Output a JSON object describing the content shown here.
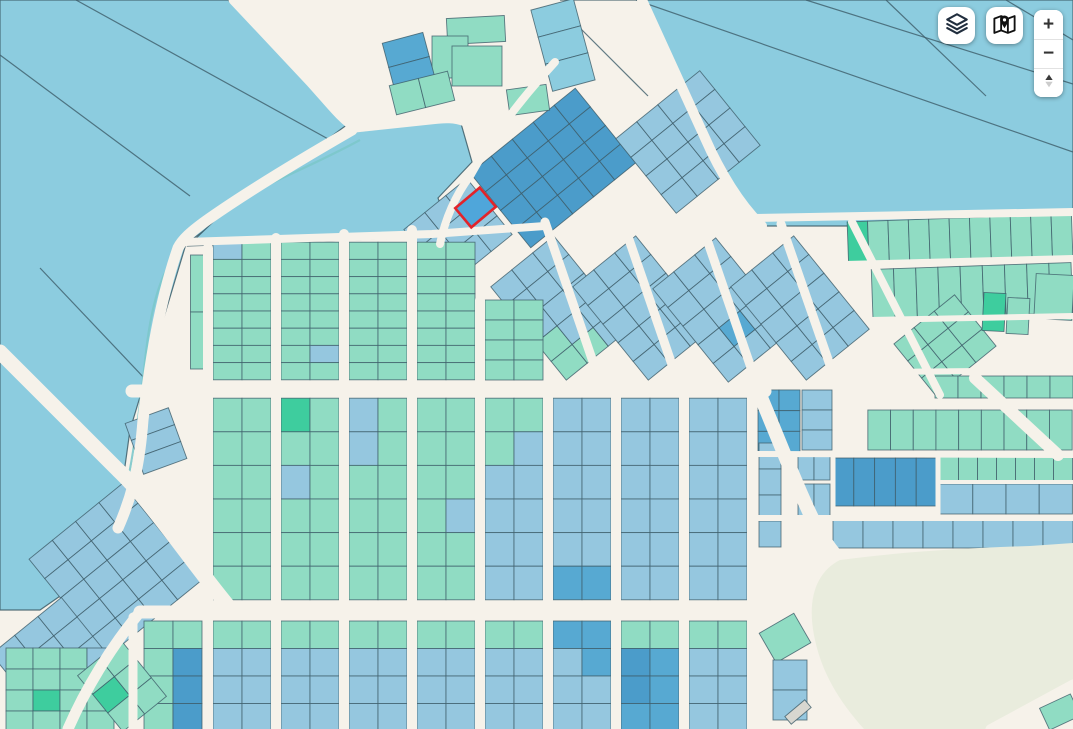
{
  "controls": {
    "layers_button": {
      "icon": "layers-icon"
    },
    "basemap_button": {
      "icon": "map-marker-icon"
    },
    "zoom_in_label": "+",
    "zoom_out_label": "−",
    "compass": {
      "icon": "compass-icon"
    }
  },
  "map": {
    "colors": {
      "st": "#f6f2ea",
      "fb": "#8cccdf",
      "lb": "#95c7df",
      "mb": "#57a9d2",
      "db": "#4b9cca",
      "t": "#90dcc3",
      "e": "#3ecd9e",
      "out": "#3d5d69",
      "beige": "#e9ecdd",
      "red": "#e2232a",
      "canal": "#7cc8cb",
      "hl": "#4fa6da",
      "gray": "#d8d7d0"
    },
    "field_polygons": [
      [
        "0,0 228,0 348,124 186,244 130,430 112,560 40,610 0,610",
        "fb"
      ],
      [
        "238,198 352,132 460,120 472,162 438,198 452,236 188,246",
        "fb"
      ],
      [
        "560,0 1073,0 1073,213 858,226 762,226 700,140 642,0",
        "fb"
      ]
    ],
    "boundary_lines": [
      [
        0,
        55,
        190,
        196
      ],
      [
        76,
        0,
        330,
        140
      ],
      [
        40,
        268,
        148,
        382
      ],
      [
        636,
        0,
        1073,
        152
      ],
      [
        806,
        0,
        1073,
        84
      ],
      [
        886,
        0,
        986,
        96
      ],
      [
        1006,
        0,
        1073,
        40
      ],
      [
        564,
        12,
        648,
        96
      ]
    ],
    "canal": "M360,140 C290,178 225,198 196,230 C162,262 152,300 146,352 C140,410 132,470 116,536",
    "grids": [
      [
        553,
        168,
        5,
        4,
        27,
        24,
        -39,
        "db",
        null
      ],
      [
        688,
        142,
        4,
        4,
        27,
        24,
        -39,
        "lb",
        null
      ],
      [
        458,
        232,
        3,
        3,
        27,
        24,
        -39,
        "lb",
        {
          "2,0": "t"
        }
      ],
      [
        560,
        308,
        3,
        5,
        27,
        24,
        -39,
        "lb",
        {
          "4,0": "t",
          "4,1": "t",
          "3,0": "t"
        }
      ],
      [
        642,
        308,
        3,
        5,
        27,
        24,
        -39,
        "lb",
        null
      ],
      [
        722,
        310,
        3,
        5,
        27,
        24,
        -39,
        "lb",
        {
          "3,1": "mb"
        }
      ],
      [
        800,
        308,
        3,
        5,
        27,
        24,
        -39,
        "lb",
        null
      ],
      [
        115,
        570,
        4,
        5,
        30,
        25,
        -39,
        "lb",
        null
      ],
      [
        50,
        655,
        3,
        3,
        30,
        25,
        -39,
        "lb",
        null
      ],
      [
        156,
        441,
        1,
        3,
        46,
        18,
        -20,
        "lb",
        null
      ],
      [
        200,
        312,
        1,
        2,
        19,
        57,
        0,
        "t",
        null
      ],
      [
        242,
        311,
        2,
        8,
        29,
        17.2,
        0,
        "t",
        {
          "0,0": "lb"
        }
      ],
      [
        310,
        311,
        2,
        8,
        29,
        17.2,
        0,
        "t",
        {
          "6,1": "lb"
        }
      ],
      [
        378,
        311,
        2,
        8,
        29,
        17.2,
        0,
        "t",
        null
      ],
      [
        446,
        311,
        2,
        8,
        29,
        17.2,
        0,
        "t",
        null
      ],
      [
        514,
        340,
        2,
        4,
        29,
        20,
        0,
        "t",
        null
      ],
      [
        242,
        499,
        2,
        6,
        29,
        33.6,
        0,
        "t",
        null
      ],
      [
        310,
        499,
        2,
        6,
        29,
        33.6,
        0,
        "t",
        {
          "0,0": "e",
          "2,0": "lb"
        }
      ],
      [
        378,
        499,
        2,
        6,
        29,
        33.6,
        0,
        "t",
        {
          "0,0": "lb",
          "1,0": "lb"
        }
      ],
      [
        446,
        499,
        2,
        6,
        29,
        33.6,
        0,
        "t",
        {
          "3,1": "lb"
        }
      ],
      [
        514,
        499,
        2,
        6,
        29,
        33.6,
        0,
        "lb",
        {
          "0,0": "t",
          "0,1": "t",
          "1,0": "t"
        }
      ],
      [
        582,
        499,
        2,
        6,
        29,
        33.6,
        0,
        "lb",
        {
          "5,0": "mb",
          "5,1": "mb"
        }
      ],
      [
        650,
        499,
        2,
        6,
        29,
        33.6,
        0,
        "lb",
        null
      ],
      [
        718,
        499,
        2,
        6,
        29,
        33.6,
        0,
        "lb",
        null
      ],
      [
        173,
        676,
        2,
        4,
        29,
        27.5,
        0,
        "t",
        {
          "1,1": "db",
          "2,1": "db",
          "3,1": "db"
        }
      ],
      [
        242,
        676,
        2,
        4,
        29,
        27.5,
        0,
        "lb",
        {
          "0,0": "t",
          "0,1": "t"
        }
      ],
      [
        310,
        676,
        2,
        4,
        29,
        27.5,
        0,
        "lb",
        {
          "0,0": "t",
          "0,1": "t"
        }
      ],
      [
        378,
        676,
        2,
        4,
        29,
        27.5,
        0,
        "lb",
        {
          "0,0": "t",
          "0,1": "t"
        }
      ],
      [
        446,
        676,
        2,
        4,
        29,
        27.5,
        0,
        "lb",
        {
          "0,0": "t",
          "0,1": "t"
        }
      ],
      [
        514,
        676,
        2,
        4,
        29,
        27.5,
        0,
        "lb",
        {
          "0,0": "t",
          "0,1": "t"
        }
      ],
      [
        582,
        676,
        2,
        4,
        29,
        27.5,
        0,
        "lb",
        {
          "0,0": "mb",
          "0,1": "mb",
          "1,1": "mb"
        }
      ],
      [
        650,
        676,
        2,
        4,
        29,
        27.5,
        0,
        "mb",
        {
          "0,0": "t",
          "0,1": "t",
          "1,0": "db",
          "2,0": "db"
        }
      ],
      [
        718,
        676,
        2,
        4,
        29,
        27.5,
        0,
        "lb",
        {
          "0,0": "t",
          "0,1": "t"
        }
      ],
      [
        60,
        690,
        4,
        4,
        27,
        21,
        0,
        "t",
        {
          "0,3": "lb",
          "2,1": "e"
        }
      ],
      [
        122,
        686,
        2,
        3,
        28,
        24,
        -39,
        "t",
        {
          "1,0": "e"
        }
      ],
      [
        960,
        239,
        11,
        1,
        20.4,
        42,
        -2,
        "t",
        {
          "0,0": "e"
        }
      ],
      [
        972,
        291,
        9,
        1,
        22.2,
        50,
        -2,
        "t",
        null
      ],
      [
        945,
        345,
        3,
        3,
        26,
        22,
        -39,
        "t",
        null
      ],
      [
        1004,
        387,
        6,
        1,
        23,
        22,
        0,
        "t",
        null
      ],
      [
        970,
        430,
        9,
        1,
        22.7,
        40,
        0,
        "t",
        null
      ],
      [
        779,
        421,
        2,
        3,
        21,
        20.7,
        0,
        "mb",
        null
      ],
      [
        817,
        420,
        1,
        3,
        30,
        20,
        0,
        "lb",
        null
      ],
      [
        885,
        482,
        5,
        1,
        20.8,
        48,
        0,
        "db",
        null
      ],
      [
        814,
        466,
        2,
        1,
        16,
        28,
        0,
        "lb",
        null
      ],
      [
        814,
        500,
        2,
        1,
        16,
        32,
        0,
        "lb",
        null
      ],
      [
        1006,
        469,
        7,
        1,
        19,
        24,
        0,
        "t",
        null
      ],
      [
        1006,
        499,
        4,
        1,
        33.2,
        30,
        0,
        "lb",
        null
      ],
      [
        953,
        534,
        8,
        1,
        30,
        28,
        0,
        "lb",
        null
      ],
      [
        1054,
        297,
        1,
        1,
        38,
        45,
        3,
        "t",
        null
      ],
      [
        994,
        312,
        1,
        1,
        22,
        38,
        3,
        "e",
        null
      ],
      [
        1018,
        316,
        1,
        1,
        22,
        36,
        3,
        "t",
        null
      ],
      [
        476,
        30,
        1,
        1,
        58,
        26,
        -3,
        "t",
        null
      ],
      [
        450,
        57,
        1,
        1,
        36,
        42,
        0,
        "t",
        null
      ],
      [
        477,
        66,
        1,
        1,
        50,
        40,
        0,
        "t",
        null
      ],
      [
        409,
        62,
        1,
        2,
        42,
        25,
        -15,
        "mb",
        null
      ],
      [
        422,
        93,
        2,
        1,
        30,
        30,
        -14,
        "t",
        null
      ],
      [
        528,
        100,
        1,
        1,
        40,
        26,
        -8,
        "t",
        null
      ],
      [
        563,
        45,
        1,
        3,
        44,
        28,
        -15,
        "fb",
        null
      ],
      [
        770,
        495,
        1,
        4,
        22,
        26,
        0,
        "lb",
        null
      ],
      [
        785,
        638,
        1,
        1,
        40,
        34,
        -30,
        "t",
        null
      ],
      [
        790,
        690,
        1,
        2,
        34,
        30,
        0,
        "lb",
        null
      ]
    ],
    "roads": [
      [
        "M233,0 L310,82 C330,104 340,118 355,128 L430,120 C445,118 455,118 465,122",
        9
      ],
      [
        "M642,0 L705,138 C720,172 740,205 762,226",
        10
      ],
      [
        "M352,130 C300,160 250,190 210,218 C190,232 182,240 178,248 C160,300 150,360 143,420 C140,460 134,492 118,528",
        11
      ],
      [
        "M0,352 C40,392 80,432 118,470 C150,500 190,560 228,606",
        15
      ],
      [
        "M132,391 L765,391",
        13
      ],
      [
        "M140,612 L762,612",
        13
      ],
      [
        "M140,612 C110,648 85,690 68,729",
        11
      ],
      [
        "M185,242 L432,234 L545,226",
        8
      ],
      [
        "M208,248 L208,729",
        10
      ],
      [
        "M276,238 L276,729",
        10
      ],
      [
        "M344,234 L344,729",
        10
      ],
      [
        "M412,230 L412,729",
        10
      ],
      [
        "M480,300 L480,729",
        10
      ],
      [
        "M548,392 L548,729",
        10
      ],
      [
        "M616,392 L616,729",
        10
      ],
      [
        "M684,392 L684,729",
        10
      ],
      [
        "M752,386 L752,729",
        10
      ],
      [
        "M133,617 L133,729",
        9
      ],
      [
        "M545,222 L603,391",
        9
      ],
      [
        "M623,222 L681,391",
        9
      ],
      [
        "M701,222 L759,391",
        9
      ],
      [
        "M781,224 L839,391",
        9
      ],
      [
        "M555,62 C520,100 490,140 470,176 C455,196 445,220 440,244",
        8
      ],
      [
        "M755,218 L1073,212",
        8
      ],
      [
        "M845,264 L1073,258",
        6
      ],
      [
        "M870,320 L1073,316",
        6
      ],
      [
        "M880,372 L1073,370",
        6
      ],
      [
        "M870,404 L1073,404",
        6
      ],
      [
        "M852,222 L940,395",
        8
      ],
      [
        "M975,378 L1058,455",
        12
      ],
      [
        "M938,455 L938,518",
        5
      ],
      [
        "M757,454 L1073,455",
        6
      ],
      [
        "M940,482 L1073,482",
        4
      ],
      [
        "M757,518 L1073,518",
        6
      ],
      [
        "M833,458 L833,508",
        5
      ],
      [
        "M757,388 C775,430 790,470 806,505 C816,528 826,545 838,558",
        14
      ],
      [
        "M838,558 C850,600 860,650 858,729",
        13
      ]
    ],
    "open_area": "M815,640 C806,600 816,572 840,560 C900,552 965,548 1030,546 L1073,543 L1073,682 L996,729 L864,729 C838,700 822,672 815,640 Z",
    "grids2": [
      [
        798,
        712,
        1,
        1,
        26,
        10,
        -40,
        "gray",
        null
      ],
      [
        1060,
        712,
        1,
        1,
        34,
        24,
        -25,
        "t",
        null
      ]
    ],
    "roads2": [
      [
        "M990,729 L1073,684",
        9
      ]
    ],
    "highlight_parcel": {
      "cx": 475.5,
      "cy": 207.5,
      "w": 32,
      "h": 25,
      "rot": -40
    }
  }
}
